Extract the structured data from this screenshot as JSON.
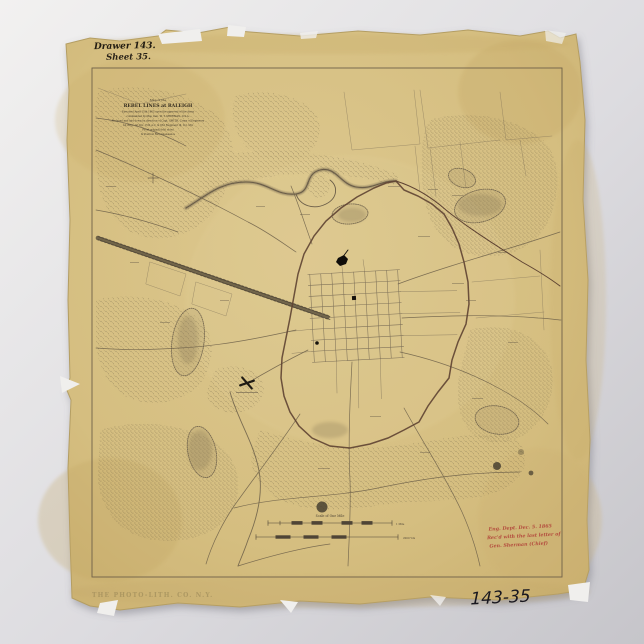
{
  "background": {
    "top_color": "#f1f0ef",
    "bottom_color": "#c7c6cb"
  },
  "paper": {
    "color": "#d7c083",
    "edge_color": "#b49e63"
  },
  "handwritten": {
    "drawer_label": "Drawer 143.",
    "sheet_label": "Sheet 35.",
    "catalog_number": "143-35"
  },
  "title_block": {
    "lines": [
      "Map of the",
      "REBEL LINES at RALEIGH",
      "Executed April 15th 1863 upon the approval of the Army",
      "commanded by Maj. Gen. W. T. SHERMAN, U.S.A.",
      "Reduced and laid down by direction of Capt. SMITH, Corps of Engineers",
      "1st Brig. 1st Div. 15th A.C. & 83d Regiment Ill. Vol. Mil.",
      "From original field notes",
      "& Position Reconnaissance"
    ]
  },
  "scale": {
    "caption": "Scale of One Mile",
    "bar1_label": "1 Mile",
    "bar2_label": "2000 Yds"
  },
  "red_note": {
    "color": "#b44d3e",
    "lines": [
      "Eng. Dept. Dec. 5. 1865",
      "Rec'd with the last letter of",
      "Gen. Sherman  (Chief)"
    ]
  },
  "stamp": {
    "text": "THE PHOTO-LITH. CO. N.Y."
  },
  "map": {
    "ink_color": "#5d5342",
    "works_line_color": "#5e4332",
    "features": [
      "river",
      "railroad",
      "city-grid",
      "entrenchment-line",
      "woods",
      "roads",
      "hills",
      "ponds",
      "battle-mark",
      "scale-bars"
    ]
  }
}
